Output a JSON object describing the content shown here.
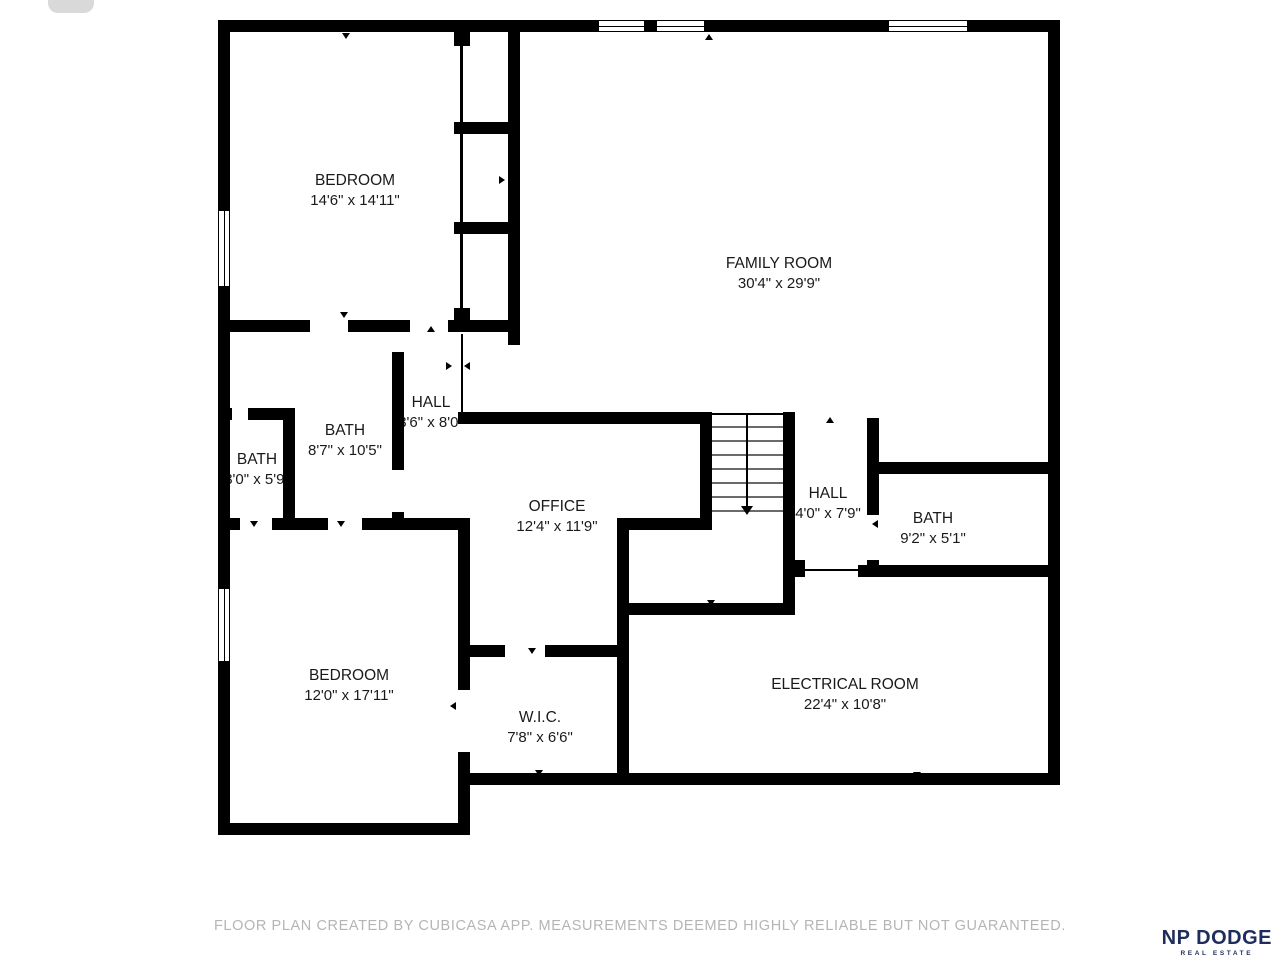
{
  "plan": {
    "rooms": [
      {
        "name": "BEDROOM",
        "dims": "14'6\" x 14'11\""
      },
      {
        "name": "FAMILY ROOM",
        "dims": "30'4\" x 29'9\""
      },
      {
        "name": "BATH",
        "dims": "8'7\" x 10'5\""
      },
      {
        "name": "HALL",
        "dims": "3'6\" x 8'0\""
      },
      {
        "name": "BATH",
        "dims": "3'0\" x 5'9\""
      },
      {
        "name": "OFFICE",
        "dims": "12'4\" x 11'9\""
      },
      {
        "name": "HALL",
        "dims": "4'0\" x 7'9\""
      },
      {
        "name": "BATH",
        "dims": "9'2\" x 5'1\""
      },
      {
        "name": "ELECTRICAL ROOM",
        "dims": "22'4\" x 10'8\""
      },
      {
        "name": "BEDROOM",
        "dims": "12'0\" x 17'11\""
      },
      {
        "name": "W.I.C.",
        "dims": "7'8\" x 6'6\""
      }
    ]
  },
  "footer": {
    "disclaimer": "FLOOR PLAN CREATED BY CUBICASA APP. MEASUREMENTS DEEMED HIGHLY RELIABLE BUT NOT GUARANTEED."
  },
  "brand": {
    "name": "NP DODGE",
    "tagline": "REAL ESTATE",
    "color": "#1e2d5e"
  },
  "colors": {
    "wall": "#000000",
    "background": "#ffffff",
    "footer_text": "#b5b5b5"
  }
}
